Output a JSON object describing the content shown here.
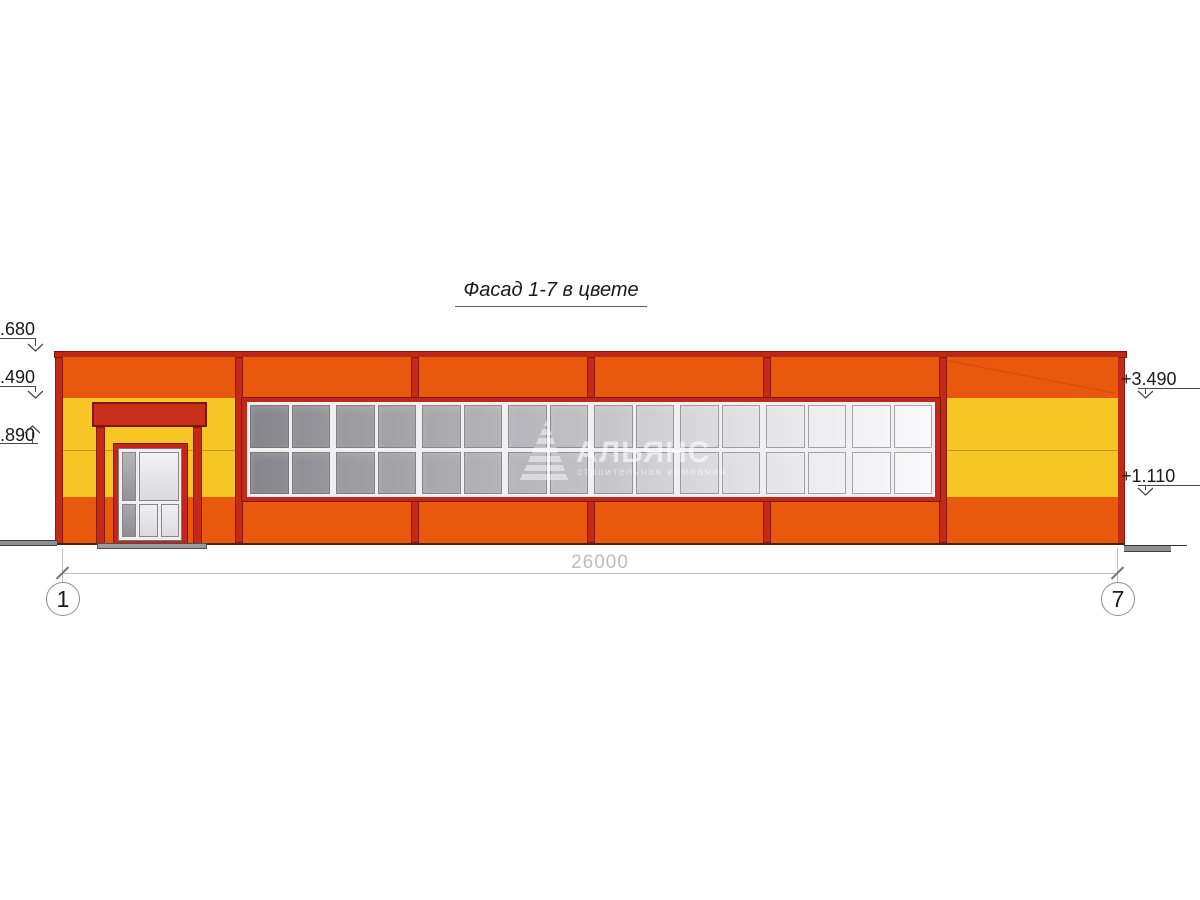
{
  "title": "Фасад 1-7 в цвете",
  "drawing": {
    "dimension_total": "26000",
    "axis_left": "1",
    "axis_right": "7",
    "elevation_marks_left": [
      {
        "label": "+4.680"
      },
      {
        "label": "+3.490"
      },
      {
        "label": "+2.890"
      }
    ],
    "elevation_marks_right": [
      {
        "label": "+3.490"
      },
      {
        "label": "+1.110"
      }
    ]
  },
  "watermark": {
    "logo": "pyramid-logo",
    "name": "АЛЬЯНС",
    "tagline": "строительная компания"
  },
  "window_grid": {
    "columns": 16,
    "rows": 2,
    "group_size": 2
  },
  "colors": {
    "facade_orange": "#E8590E",
    "facade_yellow": "#F6C724",
    "trim_red": "#C1281A",
    "trim_dark": "#7F150C",
    "glass_dark": "#84848A",
    "glass_light": "#FAFAFB",
    "ground_gray": "#8F8F8F",
    "dimension_gray": "#BDBDBD"
  }
}
